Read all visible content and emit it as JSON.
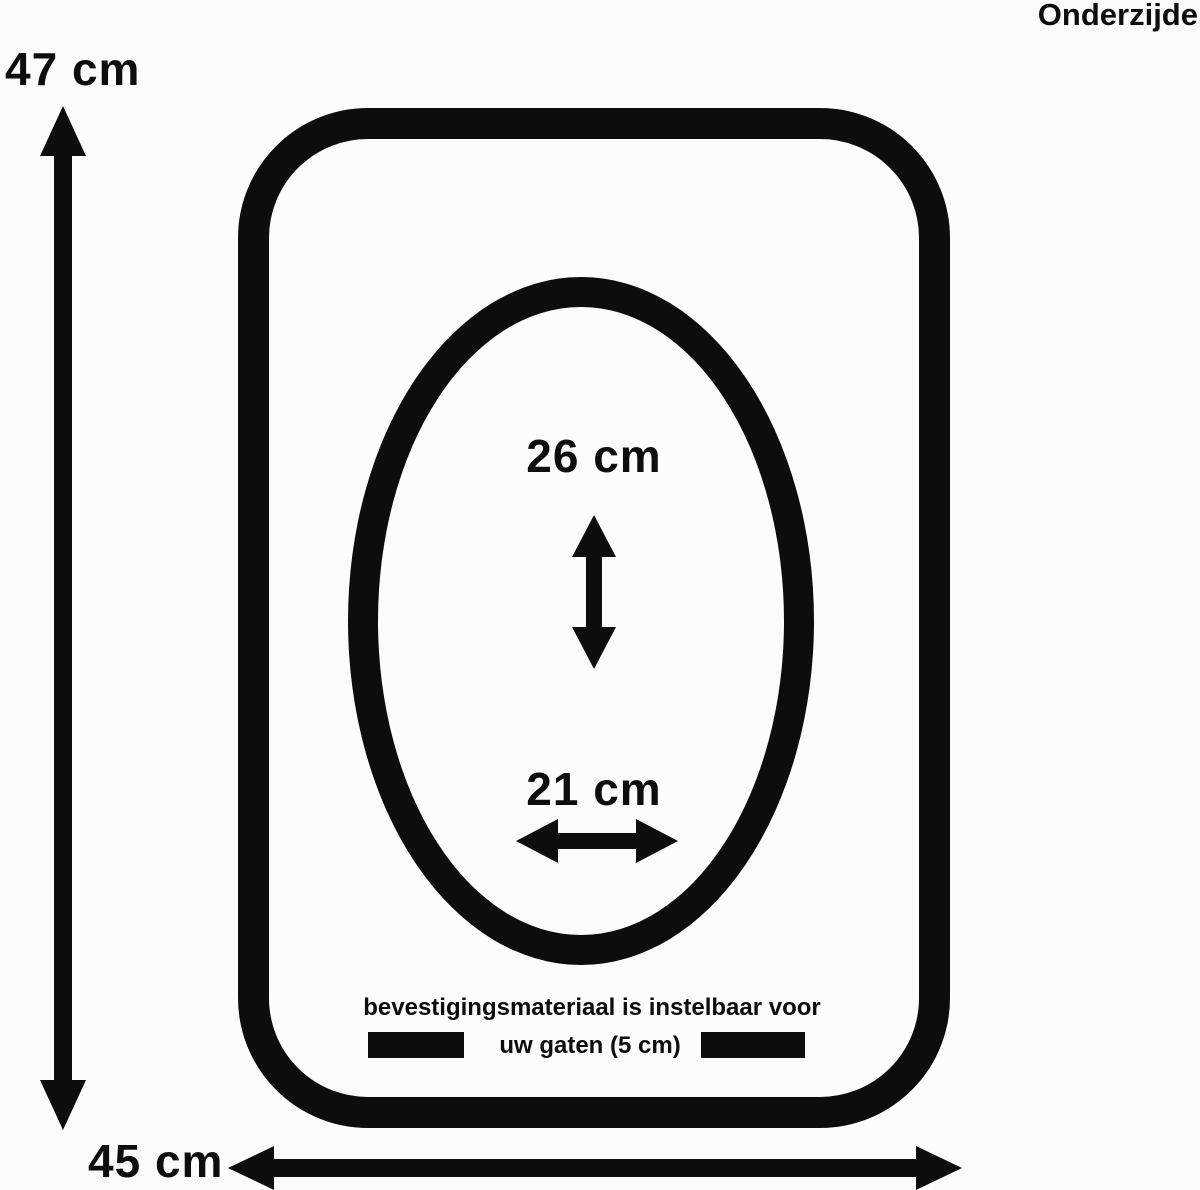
{
  "diagram": {
    "view_label": "Onderzijde",
    "overall_height_label": "47 cm",
    "overall_width_label": "45 cm",
    "hole_length_label": "26 cm",
    "hole_width_label": "21 cm",
    "note_line1": "bevestigingsmateriaal is instelbaar voor",
    "note_line2": "uw gaten (5 cm)",
    "colors": {
      "ink": "#0d0d0d",
      "background": "#fcfcfc"
    }
  }
}
